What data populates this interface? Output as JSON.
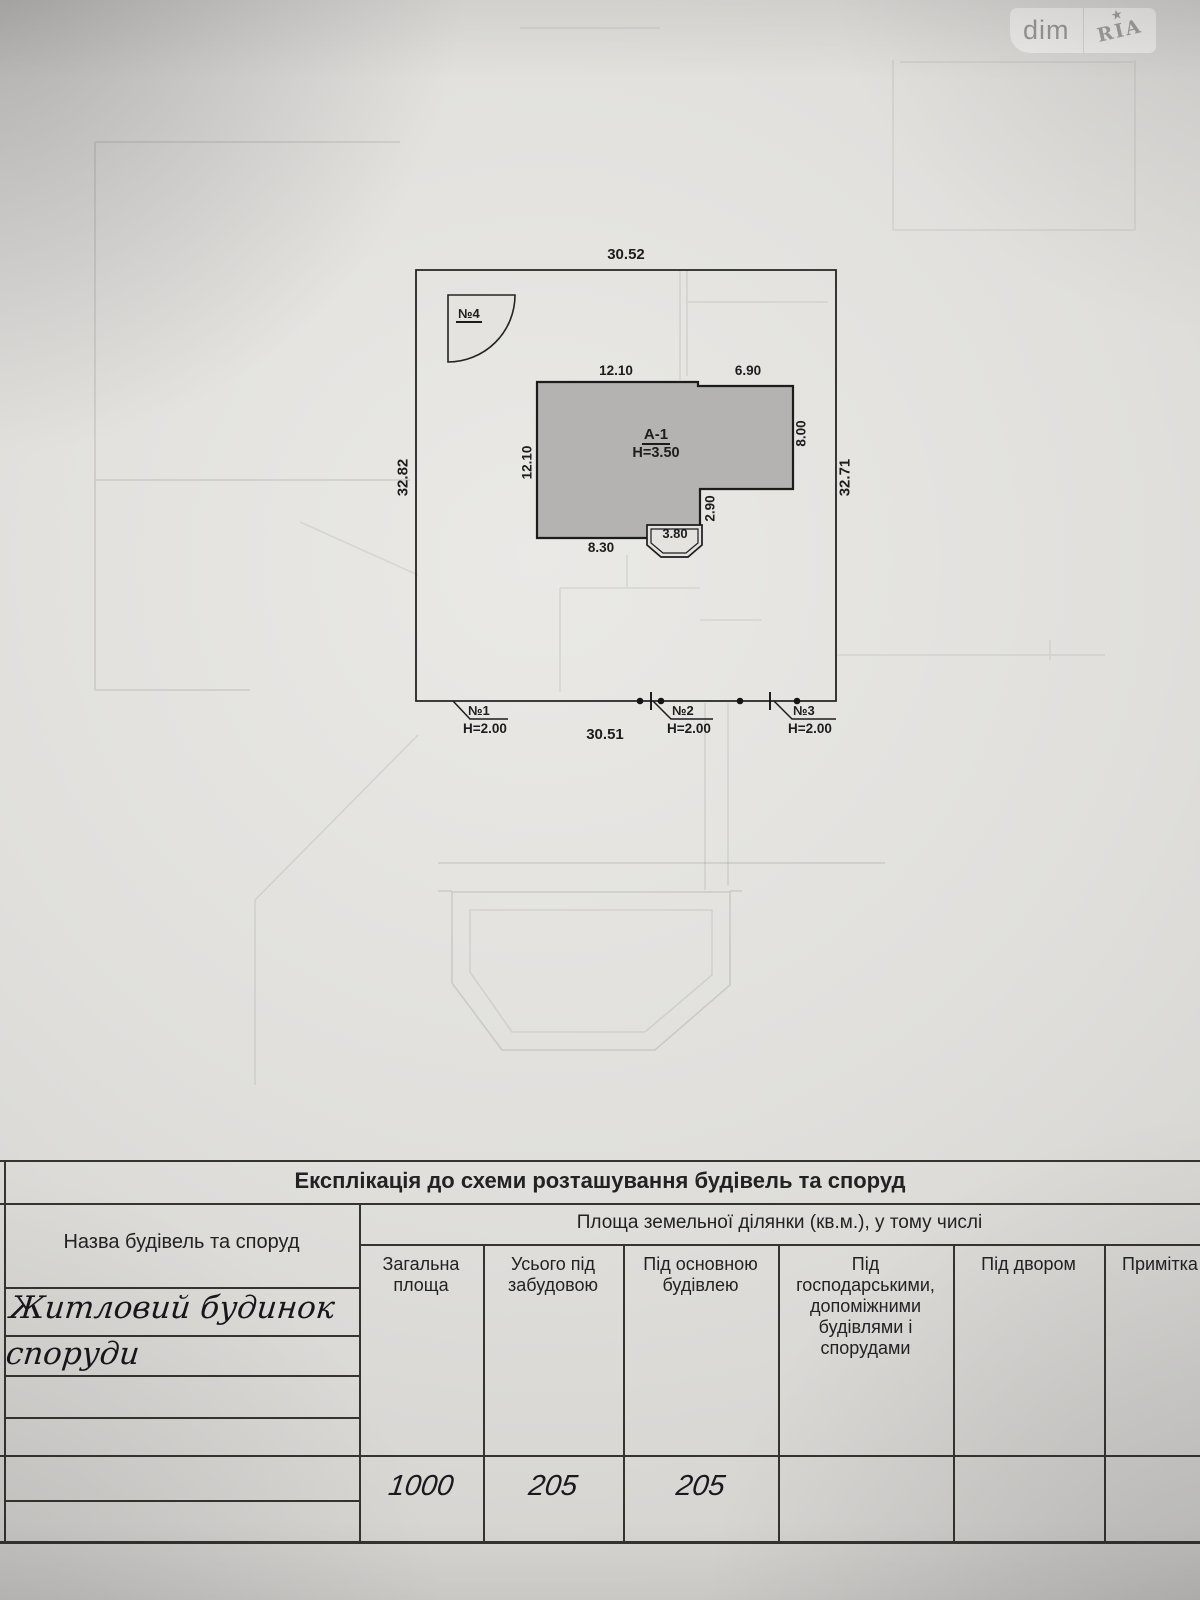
{
  "colors": {
    "paper": "#e2e1de",
    "line": "#1d1d1d",
    "building_fill": "#b4b3b1",
    "watermark_text": "#9b9b98"
  },
  "watermark": {
    "left": "dim",
    "right": "RIA",
    "star": "★"
  },
  "plan": {
    "plot_dims": {
      "top": "30.52",
      "bottom": "30.51",
      "left": "32.82",
      "right": "32.71"
    },
    "building": {
      "label": "А-1",
      "height": "Н=3.50",
      "dims": {
        "top_left": "12.10",
        "top_right": "6.90",
        "left": "12.10",
        "right": "8.00",
        "inner_right": "2.90",
        "bay": "3.80",
        "bottom": "8.30"
      }
    },
    "structures": {
      "s4": {
        "label": "№4"
      },
      "s1": {
        "label": "№1",
        "height": "Н=2.00"
      },
      "s2": {
        "label": "№2",
        "height": "Н=2.00"
      },
      "s3": {
        "label": "№3",
        "height": "Н=2.00"
      }
    }
  },
  "table": {
    "title": "Експлікація до схеми розташування будівель та споруд",
    "name_column_header": "Назва будівель та споруд",
    "area_group_header": "Площа земельної ділянки  (кв.м.), у тому числі",
    "columns": {
      "total": "Загальна площа",
      "built": "Усього під забудовою",
      "main": "Під основною будівлею",
      "aux": "Під господарськими, допоміжними будівлями і спорудами",
      "yard": "Під двором",
      "notes": "Примітка"
    },
    "entry": {
      "name_line1": "Житловий будинок",
      "name_line2": "споруди",
      "total": "1000",
      "built": "205",
      "main": "205"
    }
  }
}
